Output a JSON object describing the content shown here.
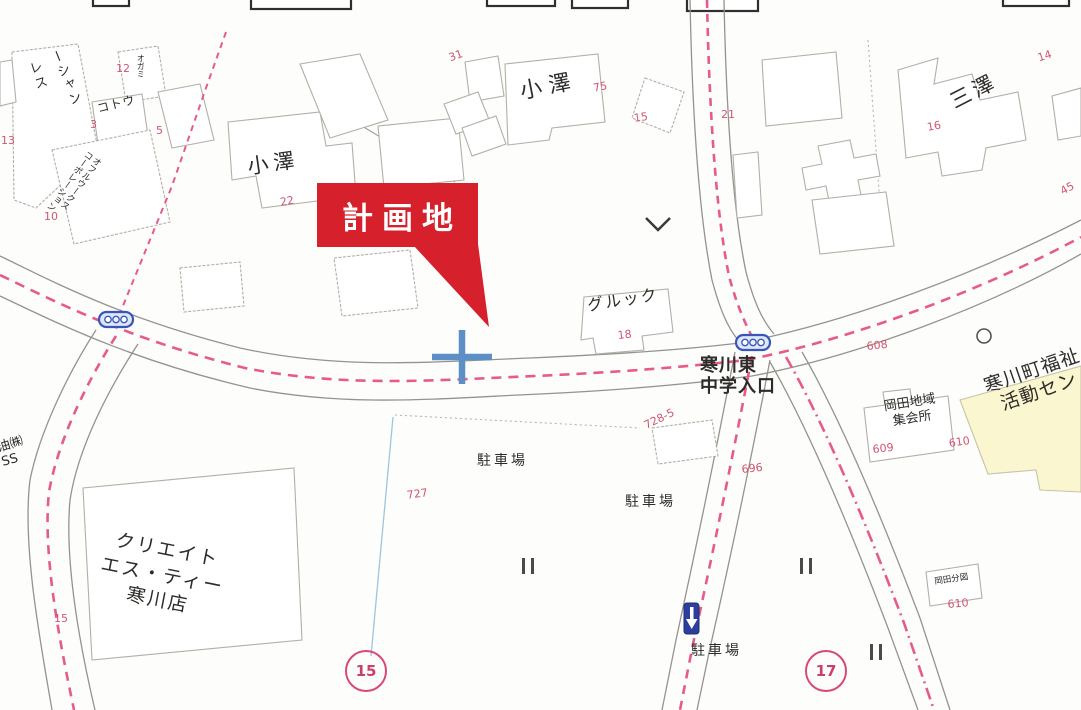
{
  "callout": {
    "text": "計画地",
    "color": "#d6202b"
  },
  "labels": [
    "小澤",
    "小澤",
    "三澤",
    "グルック",
    "寒川東\n中学入口",
    "クリエイト\nエス・ティー\n寒川店",
    "駐車場",
    "駐車場",
    "駐車場",
    "岡田地域\n集会所",
    "寒川町福祉\n活動セン",
    "コトウ",
    "レス",
    "ーシャン",
    "オフルウークス\nコーポレーション",
    "油㈱\nSS",
    "オガミ",
    "岡田分図"
  ],
  "red_numbers": [
    "12",
    "3",
    "5",
    "13",
    "10",
    "22",
    "31",
    "75",
    "15",
    "21",
    "14",
    "16",
    "45",
    "18",
    "608",
    "609",
    "610",
    "696",
    "727",
    "728-5",
    "610",
    "15"
  ],
  "route_badges": [
    "15",
    "17"
  ],
  "colors": {
    "callout_red": "#d6202b",
    "road_centerline_pink": "#e75a8e",
    "parcel_number_pink": "#d25571",
    "cross_marker_blue": "#5b8fc6",
    "traffic_signal_blue": "#3a55b8",
    "facility_fill_yellow": "#faf6cf",
    "roadside_marker_navy": "#2c3f9d"
  }
}
